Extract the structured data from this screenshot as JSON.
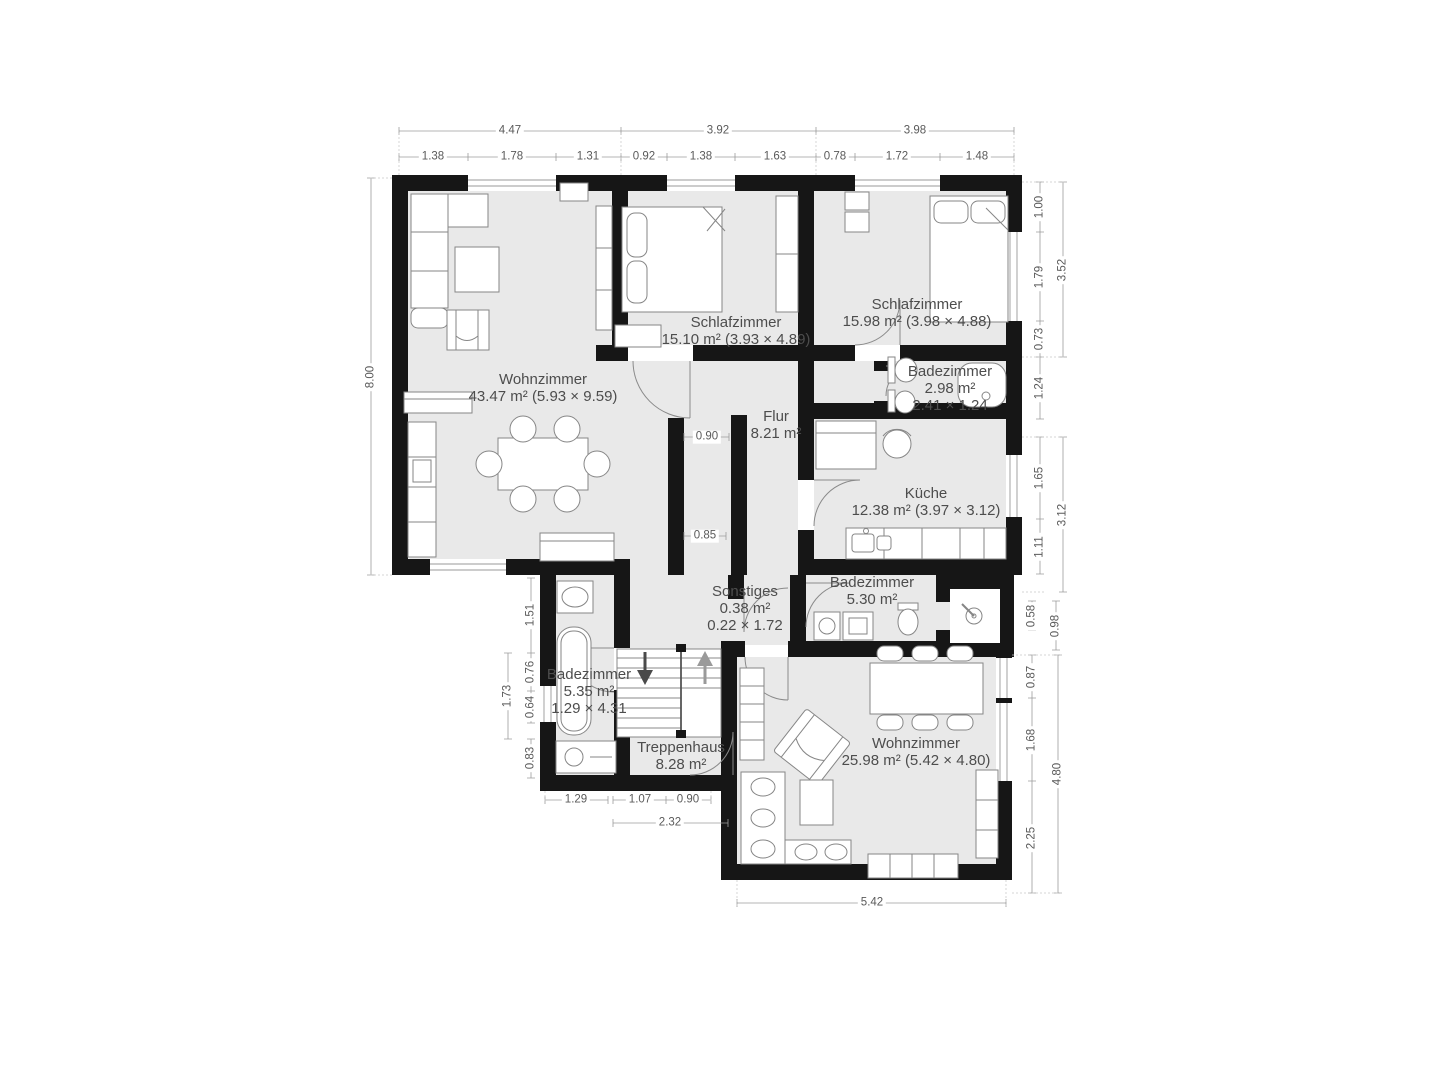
{
  "rooms": [
    {
      "id": "wohnzimmer-1",
      "name": "Wohnzimmer",
      "line2": "43.47 m² (5.93 × 9.59)",
      "line3": ""
    },
    {
      "id": "schlafzimmer-1",
      "name": "Schlafzimmer",
      "line2": "15.10 m² (3.93 × 4.89)",
      "line3": ""
    },
    {
      "id": "schlafzimmer-2",
      "name": "Schlafzimmer",
      "line2": "15.98 m² (3.98 × 4.88)",
      "line3": ""
    },
    {
      "id": "badezimmer-1",
      "name": "Badezimmer",
      "line2": "2.98 m²",
      "line3": "2.41 × 1.24"
    },
    {
      "id": "flur",
      "name": "Flur",
      "line2": "8.21 m²",
      "line3": ""
    },
    {
      "id": "kueche",
      "name": "Küche",
      "line2": "12.38 m² (3.97 × 3.12)",
      "line3": ""
    },
    {
      "id": "badezimmer-2",
      "name": "Badezimmer",
      "line2": "5.30 m²",
      "line3": ""
    },
    {
      "id": "sonstiges",
      "name": "Sonstiges",
      "line2": "0.38 m²",
      "line3": "0.22 × 1.72"
    },
    {
      "id": "badezimmer-3",
      "name": "Badezimmer",
      "line2": "5.35 m²",
      "line3": "1.29 × 4.31"
    },
    {
      "id": "treppenhaus",
      "name": "Treppenhaus",
      "line2": "8.28 m²",
      "line3": ""
    },
    {
      "id": "wohnzimmer-2",
      "name": "Wohnzimmer",
      "line2": "25.98 m² (5.42 × 4.80)",
      "line3": ""
    }
  ],
  "dims": {
    "top_main": [
      "4.47",
      "3.92",
      "3.98"
    ],
    "top_sub": [
      "1.38",
      "1.78",
      "1.31",
      "0.92",
      "1.38",
      "1.63",
      "0.78",
      "1.72",
      "1.48"
    ],
    "left": [
      "8.00",
      "1.51",
      "0.76",
      "0.64",
      "1.73",
      "0.83"
    ],
    "right": [
      "1.00",
      "1.79",
      "0.73",
      "1.24",
      "3.52",
      "1.65",
      "1.11",
      "3.12",
      "0.58",
      "0.98",
      "0.87",
      "1.68",
      "2.25",
      "4.80"
    ],
    "bottom": [
      "1.29",
      "1.07",
      "0.90",
      "2.32",
      "5.42"
    ],
    "inner": [
      "0.90",
      "0.85"
    ]
  },
  "colors": {
    "wall": "#161616",
    "room_fill": "#e9e9e9",
    "furniture_stroke": "#868686",
    "dim_line": "#9c9c9c",
    "dim_text": "#5a5a5a",
    "label_text": "#4d4d4d",
    "background": "#ffffff"
  }
}
